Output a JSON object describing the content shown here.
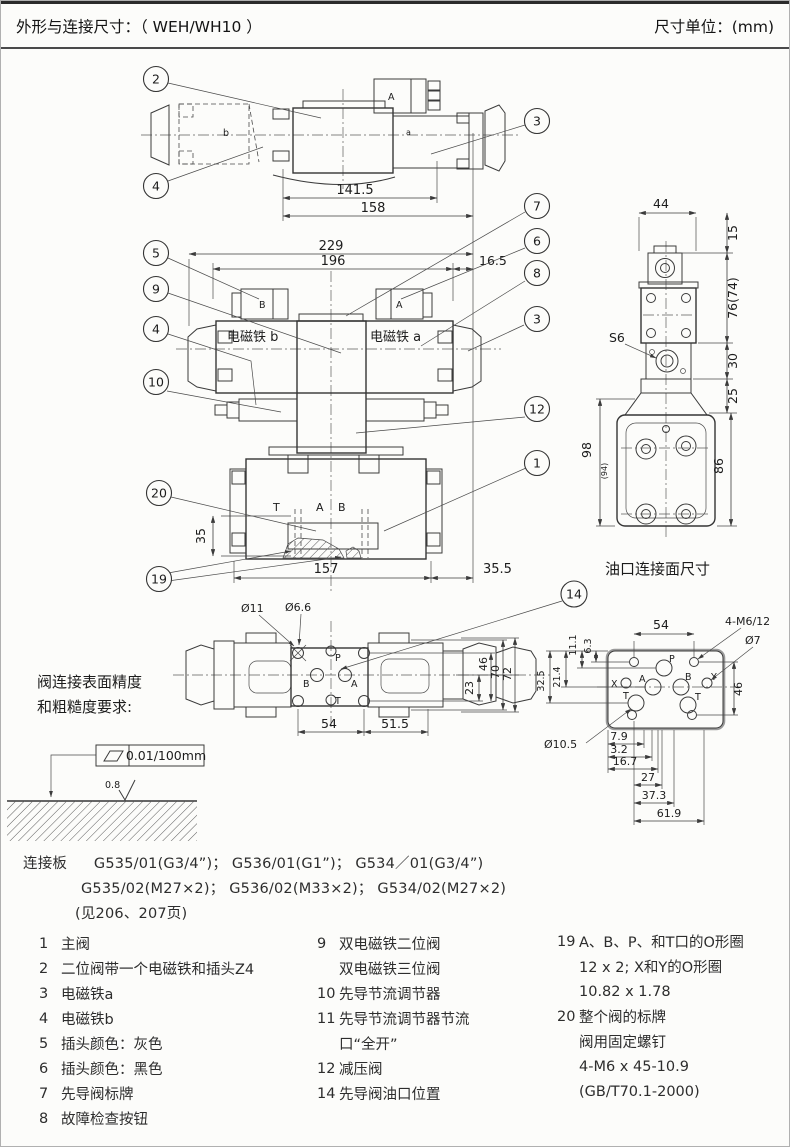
{
  "header": {
    "title": "外形与连接尺寸：（ WEH/WH10 ）",
    "unit": "尺寸单位：(mm)"
  },
  "callouts": {
    "c1": "1",
    "c2": "2",
    "c3": "3",
    "c4": "4",
    "c5": "5",
    "c6": "6",
    "c7": "7",
    "c8": "8",
    "c9": "9",
    "c10": "10",
    "c12": "12",
    "c14": "14",
    "c19": "19",
    "c20": "20"
  },
  "top_view": {
    "dim_141_5": "141.5",
    "dim_158": "158",
    "plug": "A",
    "sol_a": "a",
    "sol_b": "b"
  },
  "front_view": {
    "dim_229": "229",
    "dim_196": "196",
    "dim_16_5": "16.5",
    "dim_35": "35",
    "dim_157": "157",
    "dim_35_5": "35.5",
    "sol_b": "电磁铁 b",
    "sol_a": "电磁铁 a",
    "plug_b": "B",
    "plug_a": "A",
    "port_t": "T",
    "port_a": "A",
    "port_b": "B"
  },
  "side_view": {
    "dim_44": "44",
    "dim_15": "15",
    "dim_76": "76(74)",
    "dim_30": "30",
    "dim_25": "25",
    "dim_98": "98",
    "dim_98b": "(94)",
    "dim_86": "86",
    "s6": "S6",
    "caption": "油口连接面尺寸"
  },
  "bottom_view": {
    "dia_11": "Ø11",
    "dia_66": "Ø6.6",
    "dim_23": "23",
    "dim_46": "46",
    "dim_70": "70",
    "dim_72": "72",
    "dim_54": "54",
    "dim_51_5": "51.5",
    "port_p": "P",
    "port_b": "B",
    "port_a": "A",
    "port_t": "T"
  },
  "port_face": {
    "dim_54": "54",
    "bolts": "4-M6/12",
    "dia_7": "Ø7",
    "dim_6_3": "6.3",
    "dim_11_1": "11.1",
    "dim_21_4": "21.4",
    "dim_32_5": "32.5",
    "dim_46": "46",
    "dia_10_5": "Ø10.5",
    "dim_7_9": "7.9",
    "dim_3_2": "3.2",
    "dim_16_7": "16.7",
    "dim_27": "27",
    "dim_37_3": "37.3",
    "dim_61_9": "61.9",
    "port_p": "P",
    "port_x": "X",
    "port_a": "A",
    "port_b": "B",
    "port_y": "Y",
    "port_t1": "T",
    "port_t2": "T"
  },
  "surface_note": {
    "line1": "阀连接表面精度",
    "line2": "和粗糙度要求:",
    "flatness": "0.01/100mm",
    "roughness": "0.8"
  },
  "plate_note": {
    "label": "连接板",
    "line1": "G535/01(G3/4”)；  G536/01(G1”)；  G534／01(G3/4”)",
    "line2": "G535/02(M27×2)；  G536/02(M33×2)；  G534/02(M27×2)",
    "line3": "(见206、207页)"
  },
  "parts": {
    "col1": [
      {
        "num": "1",
        "text": "主阀"
      },
      {
        "num": "2",
        "text": "二位阀带一个电磁铁和插头Z4"
      },
      {
        "num": "3",
        "text": "电磁铁a"
      },
      {
        "num": "4",
        "text": "电磁铁b"
      },
      {
        "num": "5",
        "text": "插头颜色：灰色"
      },
      {
        "num": "6",
        "text": "插头颜色：黑色"
      },
      {
        "num": "7",
        "text": "先导阀标牌"
      },
      {
        "num": "8",
        "text": "故障检查按钮"
      }
    ],
    "col2": [
      {
        "num": "9",
        "text": "双电磁铁二位阀"
      },
      {
        "num": "",
        "text": "双电磁铁三位阀"
      },
      {
        "num": "10",
        "text": "先导节流调节器"
      },
      {
        "num": "11",
        "text": "先导节流调节器节流"
      },
      {
        "num": "",
        "text": "口“全开”"
      },
      {
        "num": "12",
        "text": "减压阀"
      },
      {
        "num": "14",
        "text": "先导阀油口位置"
      }
    ],
    "col3": [
      {
        "num": "19",
        "text": "A、B、P、和T口的O形圈"
      },
      {
        "num": "",
        "text": "12 x 2; X和Y的O形圈"
      },
      {
        "num": "",
        "text": "10.82 x 1.78"
      },
      {
        "num": "20",
        "text": "整个阀的标牌"
      },
      {
        "num": "",
        "text": "阀用固定螺钉"
      },
      {
        "num": "",
        "text": "4-M6 x 45-10.9"
      },
      {
        "num": "",
        "text": "(GB/T70.1-2000)"
      }
    ]
  }
}
